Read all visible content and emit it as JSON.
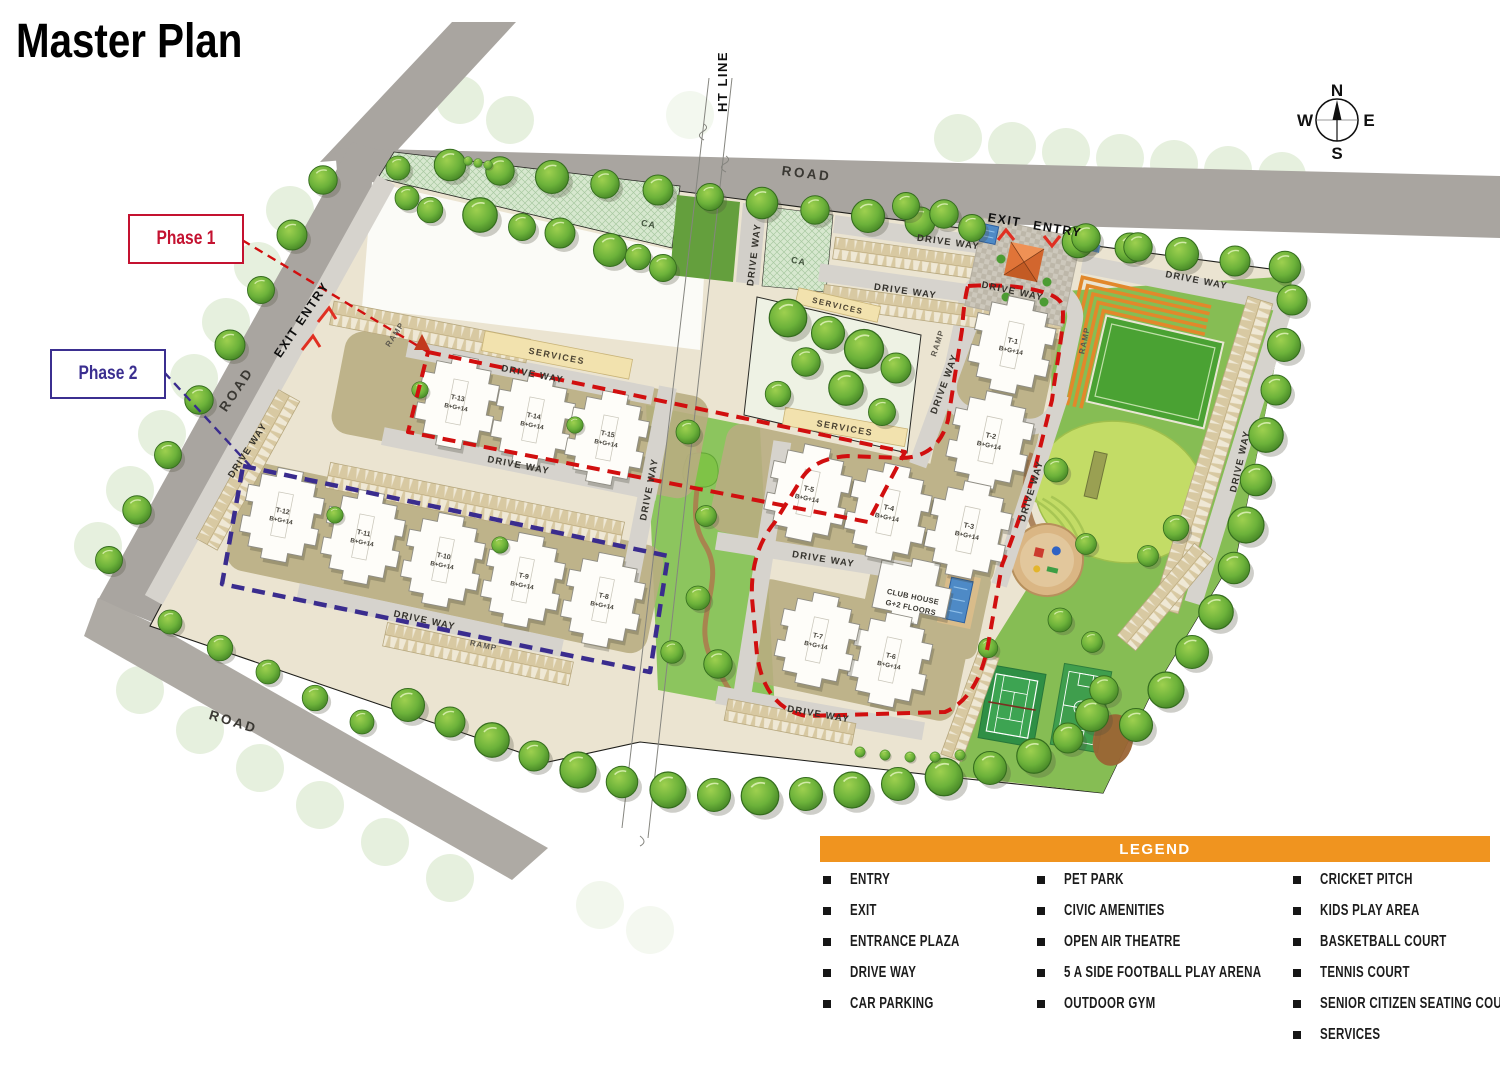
{
  "title": "Master Plan",
  "compass": {
    "north": "N",
    "south": "S",
    "east": "E",
    "west": "W"
  },
  "phases": {
    "phase1": {
      "label": "Phase 1",
      "color": "#C41230"
    },
    "phase2": {
      "label": "Phase 2",
      "color": "#3B2F90"
    }
  },
  "map_labels": {
    "ht_line": "HT LINE",
    "road": "ROAD",
    "drive_way": "DRIVE WAY",
    "services": "SERVICES",
    "ramp": "RAMP",
    "ca": "CA",
    "exit": "EXIT",
    "entry": "ENTRY",
    "exit_entry": "EXIT ENTRY",
    "club_house_line1": "CLUB HOUSE",
    "club_house_line2": "G+2 FLOORS"
  },
  "buildings": [
    {
      "id": "T-1",
      "floors": "B+G+14"
    },
    {
      "id": "T-2",
      "floors": "B+G+14"
    },
    {
      "id": "T-3",
      "floors": "B+G+14"
    },
    {
      "id": "T-4",
      "floors": "B+G+14"
    },
    {
      "id": "T-5",
      "floors": "B+G+14"
    },
    {
      "id": "T-6",
      "floors": "B+G+14"
    },
    {
      "id": "T-7",
      "floors": "B+G+14"
    },
    {
      "id": "T-8",
      "floors": "B+G+14"
    },
    {
      "id": "T-9",
      "floors": "B+G+14"
    },
    {
      "id": "T-10",
      "floors": "B+G+14"
    },
    {
      "id": "T-11",
      "floors": "B+G+14"
    },
    {
      "id": "T-12",
      "floors": "B+G+14"
    },
    {
      "id": "T-13",
      "floors": "B+G+14"
    },
    {
      "id": "T-14",
      "floors": "B+G+14"
    },
    {
      "id": "T-15",
      "floors": "B+G+14"
    }
  ],
  "legend": {
    "header": "LEGEND",
    "columns": [
      {
        "items": [
          "ENTRY",
          "EXIT",
          "ENTRANCE PLAZA",
          "DRIVE WAY",
          "CAR PARKING"
        ]
      },
      {
        "items": [
          "PET PARK",
          "CIVIC AMENITIES",
          "OPEN AIR THEATRE",
          "5 A SIDE FOOTBALL PLAY ARENA",
          "OUTDOOR GYM"
        ]
      },
      {
        "items": [
          "CRICKET PITCH",
          "KIDS PLAY AREA",
          "BASKETBALL COURT",
          "TENNIS COURT",
          "SENIOR CITIZEN SEATING COURT",
          "SERVICES"
        ]
      }
    ]
  },
  "colors": {
    "title_orange": "#F1921E",
    "legend_orange": "#F0941F",
    "phase1_red": "#C41230",
    "phase2_purple": "#3B2F90",
    "road_gray": "#A9A5A0",
    "lawn_green": "#86BD54"
  }
}
